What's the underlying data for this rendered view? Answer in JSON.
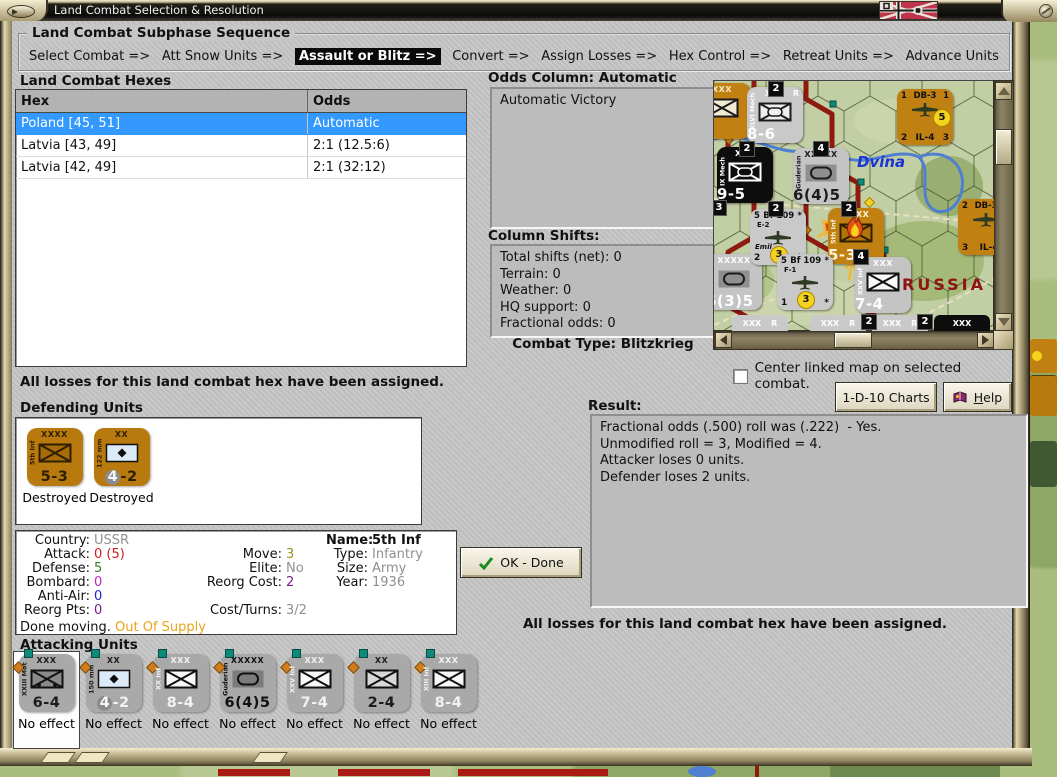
{
  "window": {
    "title": "Land Combat Selection & Resolution"
  },
  "sequence": {
    "title": "Land Combat Subphase Sequence",
    "steps": [
      {
        "label": "Select Combat =>",
        "active": false
      },
      {
        "label": "Att Snow Units =>",
        "active": false
      },
      {
        "label": "Assault or Blitz =>",
        "active": true
      },
      {
        "label": "Convert =>",
        "active": false
      },
      {
        "label": "Assign Losses =>",
        "active": false
      },
      {
        "label": "Hex Control =>",
        "active": false
      },
      {
        "label": "Retreat Units =>",
        "active": false
      },
      {
        "label": "Advance Units",
        "active": false
      }
    ]
  },
  "hex_list": {
    "title": "Land Combat Hexes",
    "columns": [
      "Hex",
      "Odds"
    ],
    "rows": [
      {
        "hex": "Poland [45, 51]",
        "odds": "Automatic",
        "selected": true
      },
      {
        "hex": "Latvia [43, 49]",
        "odds": "2:1 (12.5:6)",
        "selected": false
      },
      {
        "hex": "Latvia [42, 49]",
        "odds": "2:1 (32:12)",
        "selected": false
      }
    ]
  },
  "odds_panel": {
    "title": "Odds Column: Automatic",
    "text": "Automatic Victory"
  },
  "shifts_panel": {
    "title": "Column Shifts:",
    "lines": [
      "Total shifts (net): 0",
      "Terrain: 0",
      "Weather: 0",
      "HQ support: 0",
      "Fractional odds: 0"
    ]
  },
  "combat_type": {
    "label": "Combat Type:",
    "value": "Blitzkrieg"
  },
  "center_map_checkbox": {
    "label": "Center linked map on selected combat.",
    "checked": false
  },
  "notes": {
    "top": "All losses for this land combat hex have been assigned.",
    "bottom": "All losses for this land combat hex have been assigned."
  },
  "buttons": {
    "charts": "1-D-10 Charts",
    "help": "Help",
    "ok": "OK - Done"
  },
  "result_panel": {
    "title": "Result:",
    "lines": [
      "Fractional odds (.500) roll was (.222)  - Yes.",
      "Unmodified roll = 3, Modified = 4.",
      "Attacker loses 0 units.",
      "Defender loses 2 units."
    ]
  },
  "defending": {
    "title": "Defending Units",
    "units": [
      {
        "top": "XXXX",
        "side": "5th Inf",
        "strength": "5-3",
        "status": "Destroyed",
        "sym": "inf",
        "bg": "#b8790e",
        "ink": "#2e1e02",
        "symFill": "#a66c08",
        "symStroke": "#2e1e02",
        "circle": false
      },
      {
        "top": "XX",
        "side": "122 mm",
        "strength": "4-2",
        "status": "Destroyed",
        "sym": "art",
        "bg": "#b8790e",
        "ink": "#2e1e02",
        "symFill": "#dce9f7",
        "symStroke": "#111111",
        "circle": true
      }
    ]
  },
  "attacking": {
    "title": "Attacking Units",
    "units": [
      {
        "top": "XXX",
        "side": "XXIII Mot",
        "strength": "6-4",
        "status": "No effect",
        "sym": "mot",
        "bg": "#a9a9a9",
        "ink": "#1c1c1c",
        "symFill": "#8a8a8a",
        "symStroke": "#111111",
        "selected": true
      },
      {
        "top": "XX",
        "side": "150 mm",
        "strength": "4-2",
        "status": "No effect",
        "sym": "art",
        "bg": "#a9a9a9",
        "ink": "#1c1c1c",
        "symFill": "#dce9f7",
        "symStroke": "#111111",
        "circle": true,
        "strInk": "#f2f2f2"
      },
      {
        "top": "XXX",
        "side": "XX Inf",
        "strength": "8-4",
        "status": "No effect",
        "sym": "inf",
        "bg": "#a9a9a9",
        "ink": "#f2f2f2",
        "symFill": "#f8f8f8",
        "symStroke": "#111111"
      },
      {
        "top": "XXXXX",
        "side": "Guderian",
        "strength": "6(4)5",
        "status": "No effect",
        "sym": "armor",
        "bg": "#a9a9a9",
        "ink": "#111111",
        "symFill": "#7c7c7c",
        "symStroke": "#111111"
      },
      {
        "top": "XXX",
        "side": "XXV Inf",
        "strength": "7-4",
        "status": "No effect",
        "sym": "inf",
        "bg": "#a9a9a9",
        "ink": "#f2f2f2",
        "symFill": "#f8f8f8",
        "symStroke": "#111111"
      },
      {
        "top": "XX",
        "side": "",
        "strength": "2-4",
        "status": "No effect",
        "sym": "inf",
        "bg": "#a9a9a9",
        "ink": "#1c1c1c",
        "symFill": "#d8d8d8",
        "symStroke": "#111111"
      },
      {
        "top": "XXX",
        "side": "XIII Inf",
        "strength": "8-4",
        "status": "No effect",
        "sym": "inf",
        "bg": "#a9a9a9",
        "ink": "#f2f2f2",
        "symFill": "#f8f8f8",
        "symStroke": "#111111"
      }
    ]
  },
  "unit_info": {
    "rows": [
      [
        {
          "l": "Country:",
          "v": "USSR",
          "c": "#909090"
        },
        null,
        {
          "l": "Name:",
          "v": "5th Inf",
          "bold": true
        }
      ],
      [
        {
          "l": "Attack:",
          "v": "0 (5)",
          "c": "#cc2020"
        },
        {
          "l": "Move:",
          "v": "3",
          "c": "#99961c"
        },
        {
          "l": "Type:",
          "v": "Infantry",
          "c": "#909090"
        }
      ],
      [
        {
          "l": "Defense:",
          "v": "5",
          "c": "#2e7d1e"
        },
        {
          "l": "Elite:",
          "v": "No",
          "c": "#909090"
        },
        {
          "l": "Size:",
          "v": "Army",
          "c": "#909090"
        }
      ],
      [
        {
          "l": "Bombard:",
          "v": "0",
          "c": "#c024c0"
        },
        {
          "l": "Reorg Cost:",
          "v": "2",
          "c": "#7a1a8a"
        },
        {
          "l": "Year:",
          "v": "1936",
          "c": "#909090"
        }
      ],
      [
        {
          "l": "Anti-Air:",
          "v": "0",
          "c": "#2020c8"
        },
        null,
        null
      ],
      [
        {
          "l": "Reorg Pts:",
          "v": "0",
          "c": "#7a1a8a"
        },
        {
          "l": "Cost/Turns:",
          "v": "3/2",
          "c": "#909090"
        },
        null
      ]
    ],
    "footer": [
      {
        "t": "Done moving.",
        "c": "#111111"
      },
      {
        "t": "Out Of Supply",
        "c": "#e8a41a"
      }
    ]
  },
  "map_panel": {
    "river_label": "Dvina",
    "country_label": "RUSSIA",
    "ground_units": [
      {
        "x": -20,
        "y": 2,
        "bg": "#c08012",
        "ink": "#f5e9c8",
        "top": "XXX",
        "corner": "",
        "side": "",
        "bottom": "",
        "sym": "inf",
        "symFill": "#f2ead2",
        "symStroke": "#1a1a1a"
      },
      {
        "x": 33,
        "y": 6,
        "bg": "#c9c9c9",
        "ink": "#fdfdfd",
        "top": "XXX",
        "corner": "R",
        "side": "XLVI Mech",
        "bottom": "8-6",
        "sym": "mech",
        "symFill": "#efefef",
        "symStroke": "#1a1a1a"
      },
      {
        "x": 3,
        "y": 66,
        "bg": "#0d0d0d",
        "ink": "#fdfdfd",
        "top": "XXX",
        "corner": "",
        "side": "IX Mech",
        "bottom": "9-5",
        "sym": "mech",
        "symFill": "#0d0d0d",
        "symStroke": "#fdfdfd"
      },
      {
        "x": 79,
        "y": 67,
        "bg": "#c4c4c4",
        "ink": "#1c1c1c",
        "top": "XXXXX",
        "corner": "",
        "side": "Guderian",
        "bottom": "6(4)5",
        "sym": "armor",
        "symFill": "#8f8f8f",
        "symStroke": "#1c1c1c"
      },
      {
        "x": 114,
        "y": 127,
        "bg": "#c08012",
        "ink": "#fdf3d8",
        "top": "XXXX",
        "corner": "",
        "side": "5th Inf",
        "bottom": "5-3",
        "sym": "inf",
        "symFill": "#b27409",
        "symStroke": "#2e1e02",
        "fire": true
      },
      {
        "x": -8,
        "y": 173,
        "bg": "#c4c4c4",
        "ink": "#fdfdfd",
        "top": "XXXXX",
        "corner": "",
        "side": "Rommel",
        "bottom": "6(3)5",
        "sym": "armor",
        "symFill": "#8f8f8f",
        "symStroke": "#1c1c1c"
      },
      {
        "x": 141,
        "y": 176,
        "bg": "#c4c4c4",
        "ink": "#fdfdfd",
        "top": "XXX",
        "corner": "",
        "side": "XXV Inf",
        "bottom": "7-4",
        "sym": "inf",
        "symFill": "#f8f8f8",
        "symStroke": "#111111"
      }
    ],
    "air_units": [
      {
        "x": 183,
        "y": 8,
        "bg": "#c08012",
        "tl": "1",
        "tr": "1",
        "name": "DB-3",
        "sub": "",
        "extra": "",
        "bl": "2",
        "br": "3",
        "sub2": "IL-4",
        "badge": "5",
        "badge_pos": "r"
      },
      {
        "x": 36,
        "y": 128,
        "bg": "#c9c9c9",
        "tl": "5",
        "tr": "*",
        "name": "Bf 109",
        "sub": "E-2",
        "extra": "Emil",
        "bl": "2",
        "br": "*",
        "sub2": "",
        "badge": "3",
        "badge_pos": "b"
      },
      {
        "x": 63,
        "y": 173,
        "bg": "#c9c9c9",
        "tl": "5",
        "tr": "*",
        "name": "Bf 109",
        "sub": "F-1",
        "extra": "",
        "bl": "1",
        "br": "*",
        "sub2": "",
        "badge": "3",
        "badge_pos": "b"
      },
      {
        "x": 244,
        "y": 118,
        "bg": "#c08012",
        "tl": "2",
        "tr": "",
        "name": "DB-3F",
        "sub": "",
        "extra": "",
        "bl": "3",
        "br": "",
        "sub2": "IL-4",
        "badge": "",
        "badge_pos": ""
      }
    ],
    "badges": [
      {
        "x": 54,
        "y": 0,
        "t": "2"
      },
      {
        "x": 25,
        "y": 60,
        "t": "2"
      },
      {
        "x": 99,
        "y": 60,
        "t": "4"
      },
      {
        "x": -3,
        "y": 119,
        "t": "3"
      },
      {
        "x": 54,
        "y": 120,
        "t": "2"
      },
      {
        "x": 127,
        "y": 120,
        "t": "2"
      },
      {
        "x": 139,
        "y": 168,
        "t": "4"
      },
      {
        "x": 147,
        "y": 233,
        "t": "2"
      },
      {
        "x": 203,
        "y": 233,
        "t": "2"
      }
    ],
    "edge_units": [
      {
        "x": 18,
        "bg": "#c9c9c9",
        "t": "XXX",
        "r": "R",
        "ink": "#fdfdfd"
      },
      {
        "x": 96,
        "bg": "#c9c9c9",
        "t": "XXX",
        "r": "R",
        "ink": "#fdfdfd"
      },
      {
        "x": 158,
        "bg": "#c9c9c9",
        "t": "XXX",
        "r": "R",
        "ink": "#fdfdfd"
      },
      {
        "x": 220,
        "bg": "#0d0d0d",
        "t": "XXX",
        "r": "",
        "ink": "#fdfdfd"
      }
    ]
  },
  "colors": {
    "selection": "#3399ff",
    "counter_orange": "#b8790e",
    "counter_gray": "#a9a9a9",
    "map_green": "#c2cfa4",
    "front_red": "#8e1a10"
  }
}
